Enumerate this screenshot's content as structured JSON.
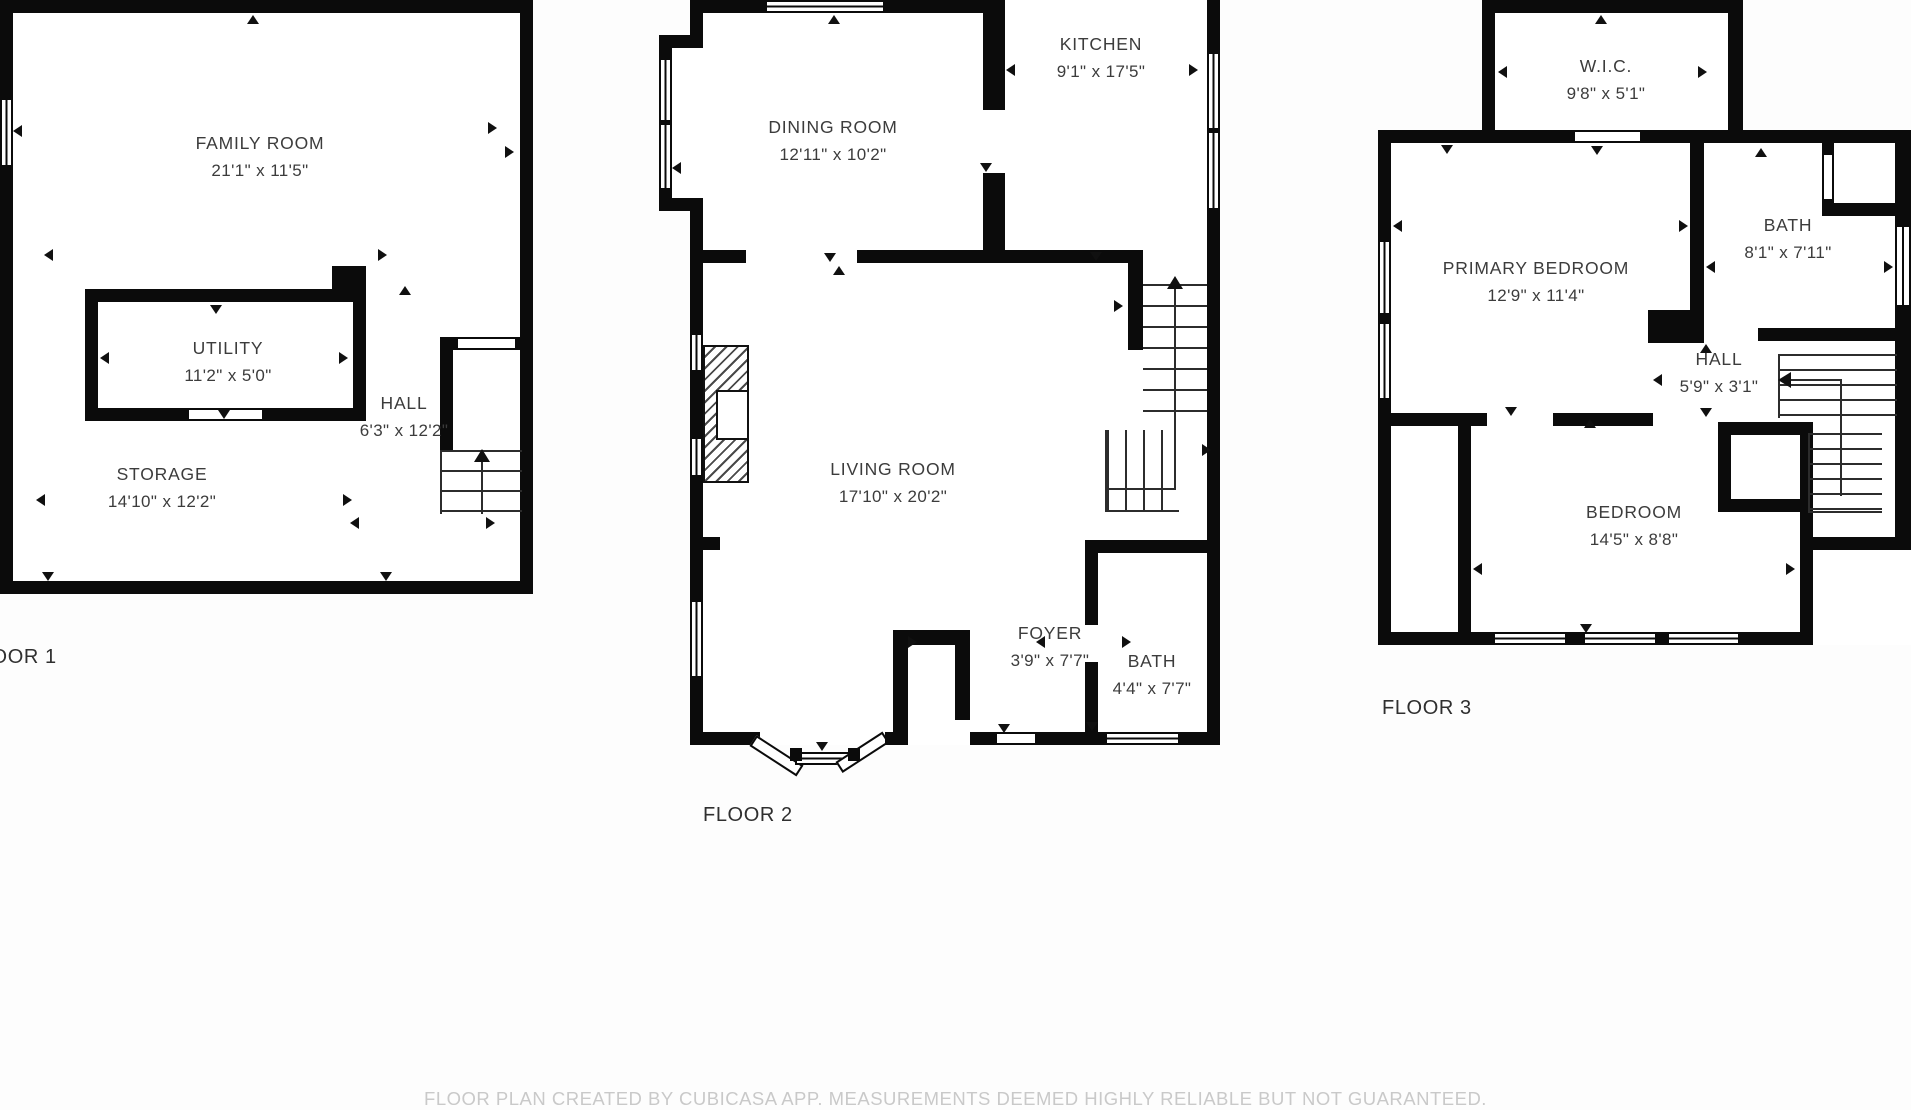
{
  "colors": {
    "wall": "#0b0b0b",
    "room_text": "#3c3c3c",
    "floor_label_text": "#2f2f2f",
    "footer_text": "#c9c9c9",
    "background": "#fdfdfd"
  },
  "floors": [
    {
      "label": "FLOOR 1",
      "rooms": [
        {
          "name": "FAMILY ROOM",
          "dims": "21'1\" x 11'5\""
        },
        {
          "name": "UTILITY",
          "dims": "11'2\" x 5'0\""
        },
        {
          "name": "HALL",
          "dims": "6'3\" x 12'2\""
        },
        {
          "name": "STORAGE",
          "dims": "14'10\" x 12'2\""
        }
      ]
    },
    {
      "label": "FLOOR 2",
      "rooms": [
        {
          "name": "DINING ROOM",
          "dims": "12'11\" x 10'2\""
        },
        {
          "name": "KITCHEN",
          "dims": "9'1\" x 17'5\""
        },
        {
          "name": "LIVING ROOM",
          "dims": "17'10\" x 20'2\""
        },
        {
          "name": "FOYER",
          "dims": "3'9\" x 7'7\""
        },
        {
          "name": "BATH",
          "dims": "4'4\" x 7'7\""
        }
      ]
    },
    {
      "label": "FLOOR 3",
      "rooms": [
        {
          "name": "W.I.C.",
          "dims": "9'8\" x 5'1\""
        },
        {
          "name": "PRIMARY BEDROOM",
          "dims": "12'9\" x 11'4\""
        },
        {
          "name": "BATH",
          "dims": "8'1\" x 7'11\""
        },
        {
          "name": "HALL",
          "dims": "5'9\" x 3'1\""
        },
        {
          "name": "BEDROOM",
          "dims": "14'5\" x 8'8\""
        }
      ]
    }
  ],
  "footer": {
    "disclaimer": "FLOOR PLAN CREATED BY CUBICASA APP. MEASUREMENTS DEEMED HIGHLY RELIABLE BUT NOT GUARANTEED."
  }
}
